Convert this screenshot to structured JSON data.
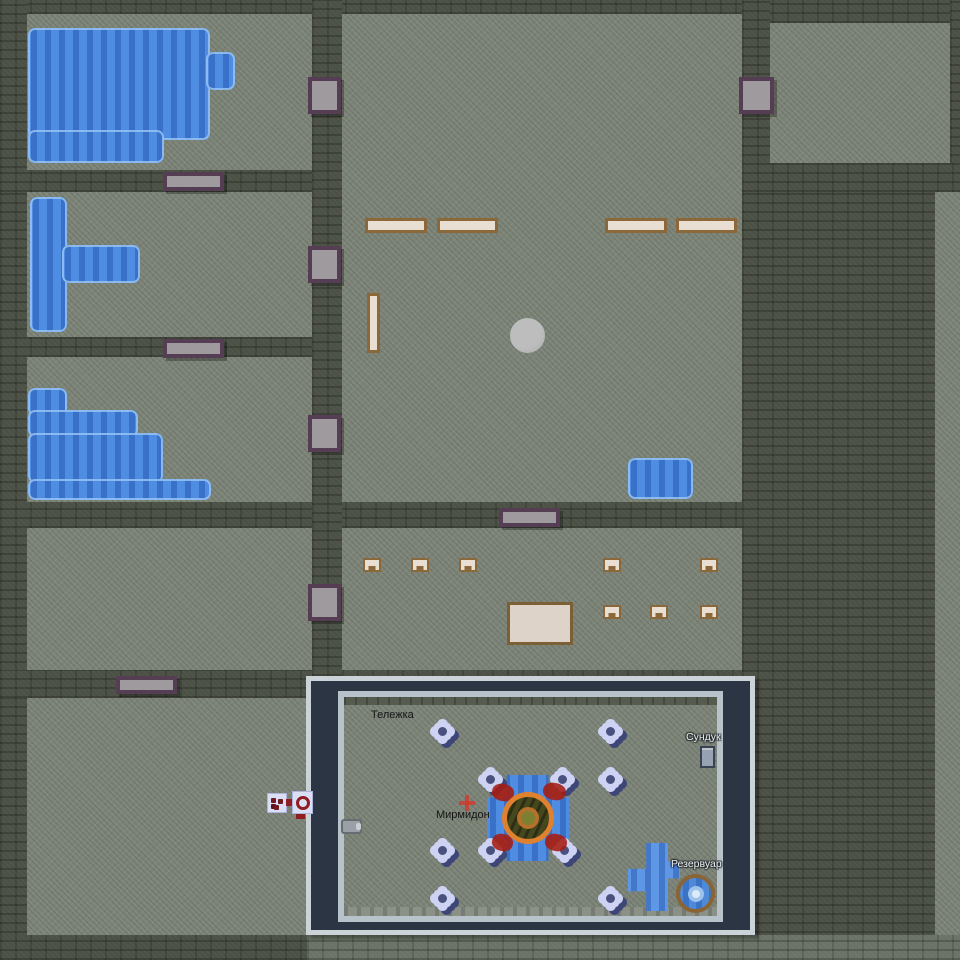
{
  "scene": {
    "type": "top-down-colony-game-map",
    "viewport_overlay": "selection-frame"
  },
  "colors": {
    "floor": "#7d8478",
    "wall": "#4c5146",
    "water": "#4f8de2",
    "panel_frame_dark": "#2c3543",
    "panel_frame_light": "#cbd2d8",
    "table_fill": "#e9ded2",
    "table_border": "#8a683a",
    "door_fill": "#9e9a9e",
    "door_border": "#553d54",
    "flower": "#ced3f3",
    "flower_shadow": "#3e4678",
    "blood": "#a61b12",
    "creature_ring": "#e0812f",
    "reservoir_ring": "#8a6434",
    "mech_red": "#8f1d22"
  },
  "labels": [
    {
      "id": "cart",
      "text": "Тележка",
      "style": "dark",
      "x": 371,
      "y": 709
    },
    {
      "id": "myrmidon",
      "text": "Мирмидон",
      "style": "dark",
      "x": 436,
      "y": 809
    },
    {
      "id": "chest",
      "text": "Сундук",
      "style": "light",
      "x": 686,
      "y": 731
    },
    {
      "id": "reservoir",
      "text": "Резервуар",
      "style": "light",
      "x": 671,
      "y": 858
    }
  ],
  "sprites": [
    {
      "t": "door-v",
      "n": "door",
      "i": true,
      "x": 308,
      "y": 77,
      "w": 33,
      "h": 37
    },
    {
      "t": "door-v",
      "n": "door",
      "i": true,
      "x": 308,
      "y": 246,
      "w": 33,
      "h": 37
    },
    {
      "t": "door-v",
      "n": "door",
      "i": true,
      "x": 308,
      "y": 415,
      "w": 33,
      "h": 37
    },
    {
      "t": "door-v",
      "n": "door",
      "i": true,
      "x": 308,
      "y": 584,
      "w": 33,
      "h": 37
    },
    {
      "t": "door-v",
      "n": "door",
      "i": true,
      "x": 739,
      "y": 77,
      "w": 35,
      "h": 37
    },
    {
      "t": "door-h",
      "n": "door",
      "i": true,
      "x": 163,
      "y": 172,
      "w": 61,
      "h": 19
    },
    {
      "t": "door-h",
      "n": "door",
      "i": true,
      "x": 163,
      "y": 339,
      "w": 61,
      "h": 19
    },
    {
      "t": "door-h",
      "n": "door",
      "i": true,
      "x": 116,
      "y": 676,
      "w": 61,
      "h": 18
    },
    {
      "t": "door-h",
      "n": "door",
      "i": true,
      "x": 499,
      "y": 508,
      "w": 61,
      "h": 19
    },
    {
      "t": "water",
      "n": "water-pool",
      "i": false,
      "x": 28,
      "y": 28,
      "w": 182,
      "h": 112
    },
    {
      "t": "water",
      "n": "water-pool",
      "i": false,
      "x": 28,
      "y": 130,
      "w": 136,
      "h": 33
    },
    {
      "t": "water",
      "n": "water-pool",
      "i": false,
      "x": 206,
      "y": 52,
      "w": 29,
      "h": 38
    },
    {
      "t": "water",
      "n": "water-pool",
      "i": false,
      "x": 30,
      "y": 197,
      "w": 37,
      "h": 135
    },
    {
      "t": "water",
      "n": "water-pool",
      "i": false,
      "x": 62,
      "y": 245,
      "w": 78,
      "h": 38
    },
    {
      "t": "water",
      "n": "water-pool",
      "i": false,
      "x": 28,
      "y": 388,
      "w": 39,
      "h": 28
    },
    {
      "t": "water",
      "n": "water-pool",
      "i": false,
      "x": 28,
      "y": 410,
      "w": 110,
      "h": 27
    },
    {
      "t": "water",
      "n": "water-pool",
      "i": false,
      "x": 28,
      "y": 433,
      "w": 135,
      "h": 50
    },
    {
      "t": "water",
      "n": "water-pool",
      "i": false,
      "x": 28,
      "y": 479,
      "w": 183,
      "h": 21
    },
    {
      "t": "water",
      "n": "water-pool",
      "i": false,
      "x": 628,
      "y": 458,
      "w": 65,
      "h": 41
    },
    {
      "t": "pond",
      "n": "water-pond",
      "i": false,
      "x": 487,
      "y": 775,
      "w": 82,
      "h": 86
    },
    {
      "t": "channel",
      "n": "water-channel",
      "i": false,
      "x": 628,
      "y": 843,
      "w": 52,
      "h": 68
    },
    {
      "t": "table-h",
      "n": "table",
      "i": true,
      "x": 365,
      "y": 218,
      "w": 62,
      "h": 15
    },
    {
      "t": "table-h",
      "n": "table",
      "i": true,
      "x": 437,
      "y": 218,
      "w": 61,
      "h": 15
    },
    {
      "t": "table-h",
      "n": "table",
      "i": true,
      "x": 605,
      "y": 218,
      "w": 62,
      "h": 15
    },
    {
      "t": "table-h",
      "n": "table",
      "i": true,
      "x": 676,
      "y": 218,
      "w": 61,
      "h": 15
    },
    {
      "t": "table-v",
      "n": "table",
      "i": true,
      "x": 367,
      "y": 293,
      "w": 13,
      "h": 60
    },
    {
      "t": "table-big",
      "n": "table",
      "i": true,
      "x": 507,
      "y": 602,
      "w": 66,
      "h": 43
    },
    {
      "t": "chair",
      "n": "chair",
      "i": true,
      "x": 363,
      "y": 558,
      "w": 18,
      "h": 14
    },
    {
      "t": "chair",
      "n": "chair",
      "i": true,
      "x": 411,
      "y": 558,
      "w": 18,
      "h": 14
    },
    {
      "t": "chair",
      "n": "chair",
      "i": true,
      "x": 459,
      "y": 558,
      "w": 18,
      "h": 14
    },
    {
      "t": "chair",
      "n": "chair",
      "i": true,
      "x": 603,
      "y": 558,
      "w": 18,
      "h": 14
    },
    {
      "t": "chair",
      "n": "chair",
      "i": true,
      "x": 700,
      "y": 558,
      "w": 18,
      "h": 14
    },
    {
      "t": "chair",
      "n": "chair",
      "i": true,
      "x": 603,
      "y": 605,
      "w": 18,
      "h": 14
    },
    {
      "t": "chair",
      "n": "chair",
      "i": true,
      "x": 650,
      "y": 605,
      "w": 18,
      "h": 14
    },
    {
      "t": "chair",
      "n": "chair",
      "i": true,
      "x": 700,
      "y": 605,
      "w": 18,
      "h": 14
    },
    {
      "t": "boulder",
      "n": "boulder",
      "i": true,
      "x": 510,
      "y": 318,
      "w": 35,
      "h": 35
    },
    {
      "t": "flower",
      "n": "flower",
      "i": true,
      "x": 434,
      "y": 723,
      "w": 20,
      "h": 20
    },
    {
      "t": "flower",
      "n": "flower",
      "i": true,
      "x": 602,
      "y": 723,
      "w": 20,
      "h": 20
    },
    {
      "t": "flower",
      "n": "flower",
      "i": true,
      "x": 482,
      "y": 771,
      "w": 20,
      "h": 20
    },
    {
      "t": "flower",
      "n": "flower",
      "i": true,
      "x": 554,
      "y": 771,
      "w": 20,
      "h": 20
    },
    {
      "t": "flower",
      "n": "flower",
      "i": true,
      "x": 602,
      "y": 771,
      "w": 20,
      "h": 20
    },
    {
      "t": "flower",
      "n": "flower",
      "i": true,
      "x": 434,
      "y": 842,
      "w": 20,
      "h": 20
    },
    {
      "t": "flower",
      "n": "flower",
      "i": true,
      "x": 482,
      "y": 842,
      "w": 20,
      "h": 20
    },
    {
      "t": "flower",
      "n": "flower",
      "i": true,
      "x": 556,
      "y": 842,
      "w": 20,
      "h": 20
    },
    {
      "t": "flower",
      "n": "flower",
      "i": true,
      "x": 434,
      "y": 890,
      "w": 20,
      "h": 20
    },
    {
      "t": "flower",
      "n": "flower",
      "i": true,
      "x": 602,
      "y": 890,
      "w": 20,
      "h": 20
    },
    {
      "t": "blood",
      "n": "blood-stain",
      "i": false,
      "x": 492,
      "y": 784,
      "w": 22,
      "h": 17
    },
    {
      "t": "blood",
      "n": "blood-stain",
      "i": false,
      "x": 543,
      "y": 783,
      "w": 23,
      "h": 17
    },
    {
      "t": "blood",
      "n": "blood-stain",
      "i": false,
      "x": 492,
      "y": 834,
      "w": 21,
      "h": 17
    },
    {
      "t": "blood",
      "n": "blood-stain",
      "i": false,
      "x": 545,
      "y": 834,
      "w": 22,
      "h": 17
    },
    {
      "t": "sparkle",
      "n": "red-sparkle",
      "i": false,
      "x": 459,
      "y": 795,
      "w": 16,
      "h": 16
    },
    {
      "t": "creature",
      "n": "myrmidon-creature",
      "i": true,
      "x": 502,
      "y": 792,
      "w": 52,
      "h": 52
    },
    {
      "t": "chest",
      "n": "chest",
      "i": true,
      "x": 700,
      "y": 746,
      "w": 15,
      "h": 22
    },
    {
      "t": "reservoir",
      "n": "reservoir",
      "i": true,
      "x": 676,
      "y": 874,
      "w": 39,
      "h": 39
    },
    {
      "t": "lever",
      "n": "lever",
      "i": true,
      "x": 341,
      "y": 819,
      "w": 21,
      "h": 15
    },
    {
      "t": "mech mech-parts",
      "n": "mechanism-icon",
      "i": true,
      "x": 267,
      "y": 793,
      "w": 20,
      "h": 20
    },
    {
      "t": "mech-bar",
      "n": "mechanism-link",
      "i": false,
      "x": 286,
      "y": 799,
      "w": 7,
      "h": 7
    },
    {
      "t": "mech mech-wheel",
      "n": "mechanism-wheel-icon",
      "i": true,
      "x": 292,
      "y": 791,
      "w": 21,
      "h": 23
    },
    {
      "t": "mech-stub",
      "n": "mechanism-stub",
      "i": false,
      "x": 296,
      "y": 814,
      "w": 9,
      "h": 5
    }
  ]
}
